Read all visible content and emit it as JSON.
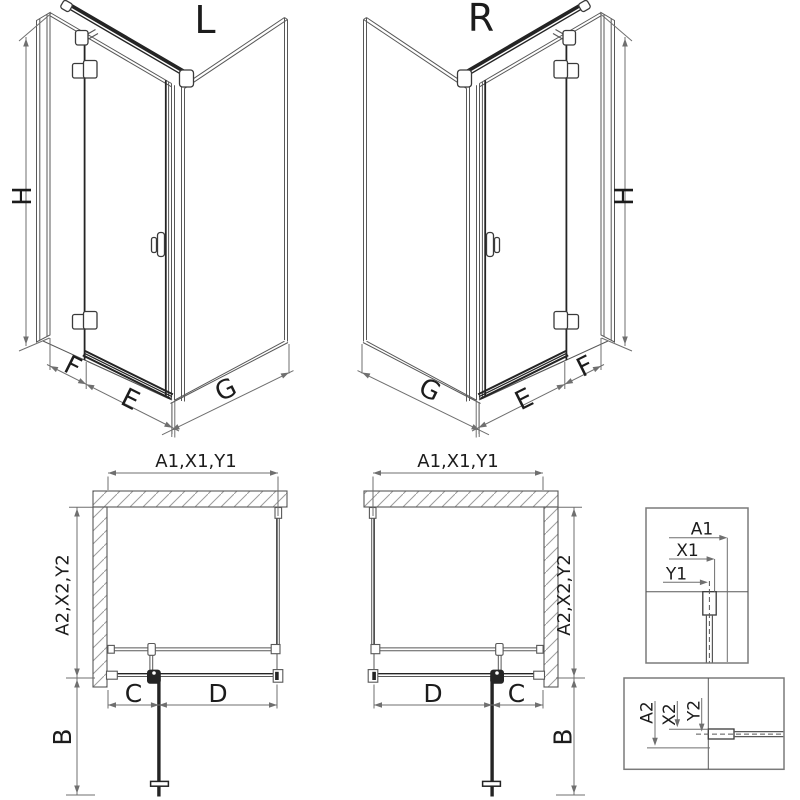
{
  "drawing": {
    "variants": {
      "left": "L",
      "right": "R"
    },
    "iso_dimensions": {
      "height": "H",
      "fixed_panel_width": "F",
      "door_width": "E",
      "side_panel_width": "G"
    },
    "plan_dimensions": {
      "total_width": "A1,X1,Y1",
      "total_depth": "A2,X2,Y2",
      "wall_to_hinge": "C",
      "hinge_to_corner": "D",
      "door_swing_clearance": "B"
    },
    "width_measure_points": {
      "outer": "A1",
      "profile_edge": "X1",
      "glass_axis": "Y1"
    },
    "depth_measure_points": {
      "outer": "A2",
      "profile_edge": "X2",
      "glass_axis": "Y2"
    },
    "colors": {
      "line": "#585858",
      "dark": "#242424",
      "dim": "#6f6f6f",
      "hatch": "#9c9c9c",
      "text": "#1c1c1c",
      "background": "#ffffff"
    }
  }
}
